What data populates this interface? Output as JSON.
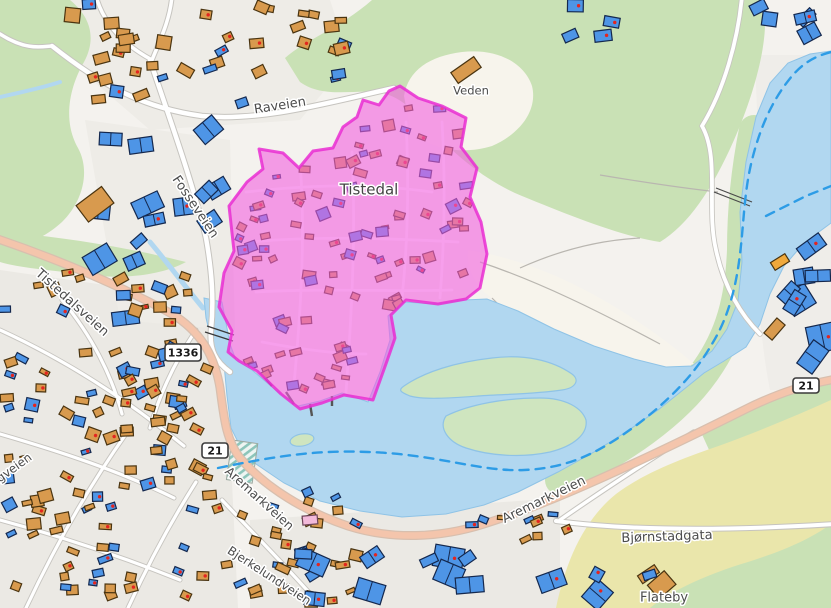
{
  "map": {
    "labels": {
      "tistedal": "Tistedal",
      "veden": "Veden",
      "flateby": "Flateby",
      "raveien": "Raveien",
      "fosseveien": "Fosseveien",
      "tistedalsveien": "Tistedalsveien",
      "aremarkveien_west": "Aremarkveien",
      "aremarkveien_east": "Aremarkveien",
      "bjornstadgata": "Bjørnstadgata",
      "bjerkelundveien": "Bjerkelundveien",
      "lyngveien": "Lyngveien",
      "badge_21": "21",
      "badge_1336": "1336"
    },
    "selection": {
      "place": "Tistedal",
      "fill": "#f15fe0",
      "stroke": "#e92ed2"
    },
    "colors": {
      "water": "#b1d7f0",
      "water_edge": "#8fc3e6",
      "vegetation": "#c9e1b5",
      "island": "#cfe5bf",
      "farmland": "#eae6ab",
      "urban_base": "#f4f2ee",
      "urban_parcel": "#ebe9e4",
      "clearing": "#f7f4ec",
      "road_major_fill": "#f4c5ac",
      "road_major_casing": "#d8bfae",
      "road_minor_casing": "#c6c4bf",
      "building_blue": "#4e95e6",
      "building_blue_outline": "#14284e",
      "building_orange": "#d89a4e",
      "building_orange_outline": "#4a3410",
      "building_dot": "#e3251f",
      "selection_fill": "#f15fe0",
      "selection_stroke": "#e92ed2",
      "boundary_dash": "#2d9ce6",
      "label": "#4c4c4c",
      "badge_bg": "#ffffff",
      "badge_border": "#3a3a3a",
      "pier": "#555555",
      "stripe_field": "#8cc5ba"
    }
  }
}
